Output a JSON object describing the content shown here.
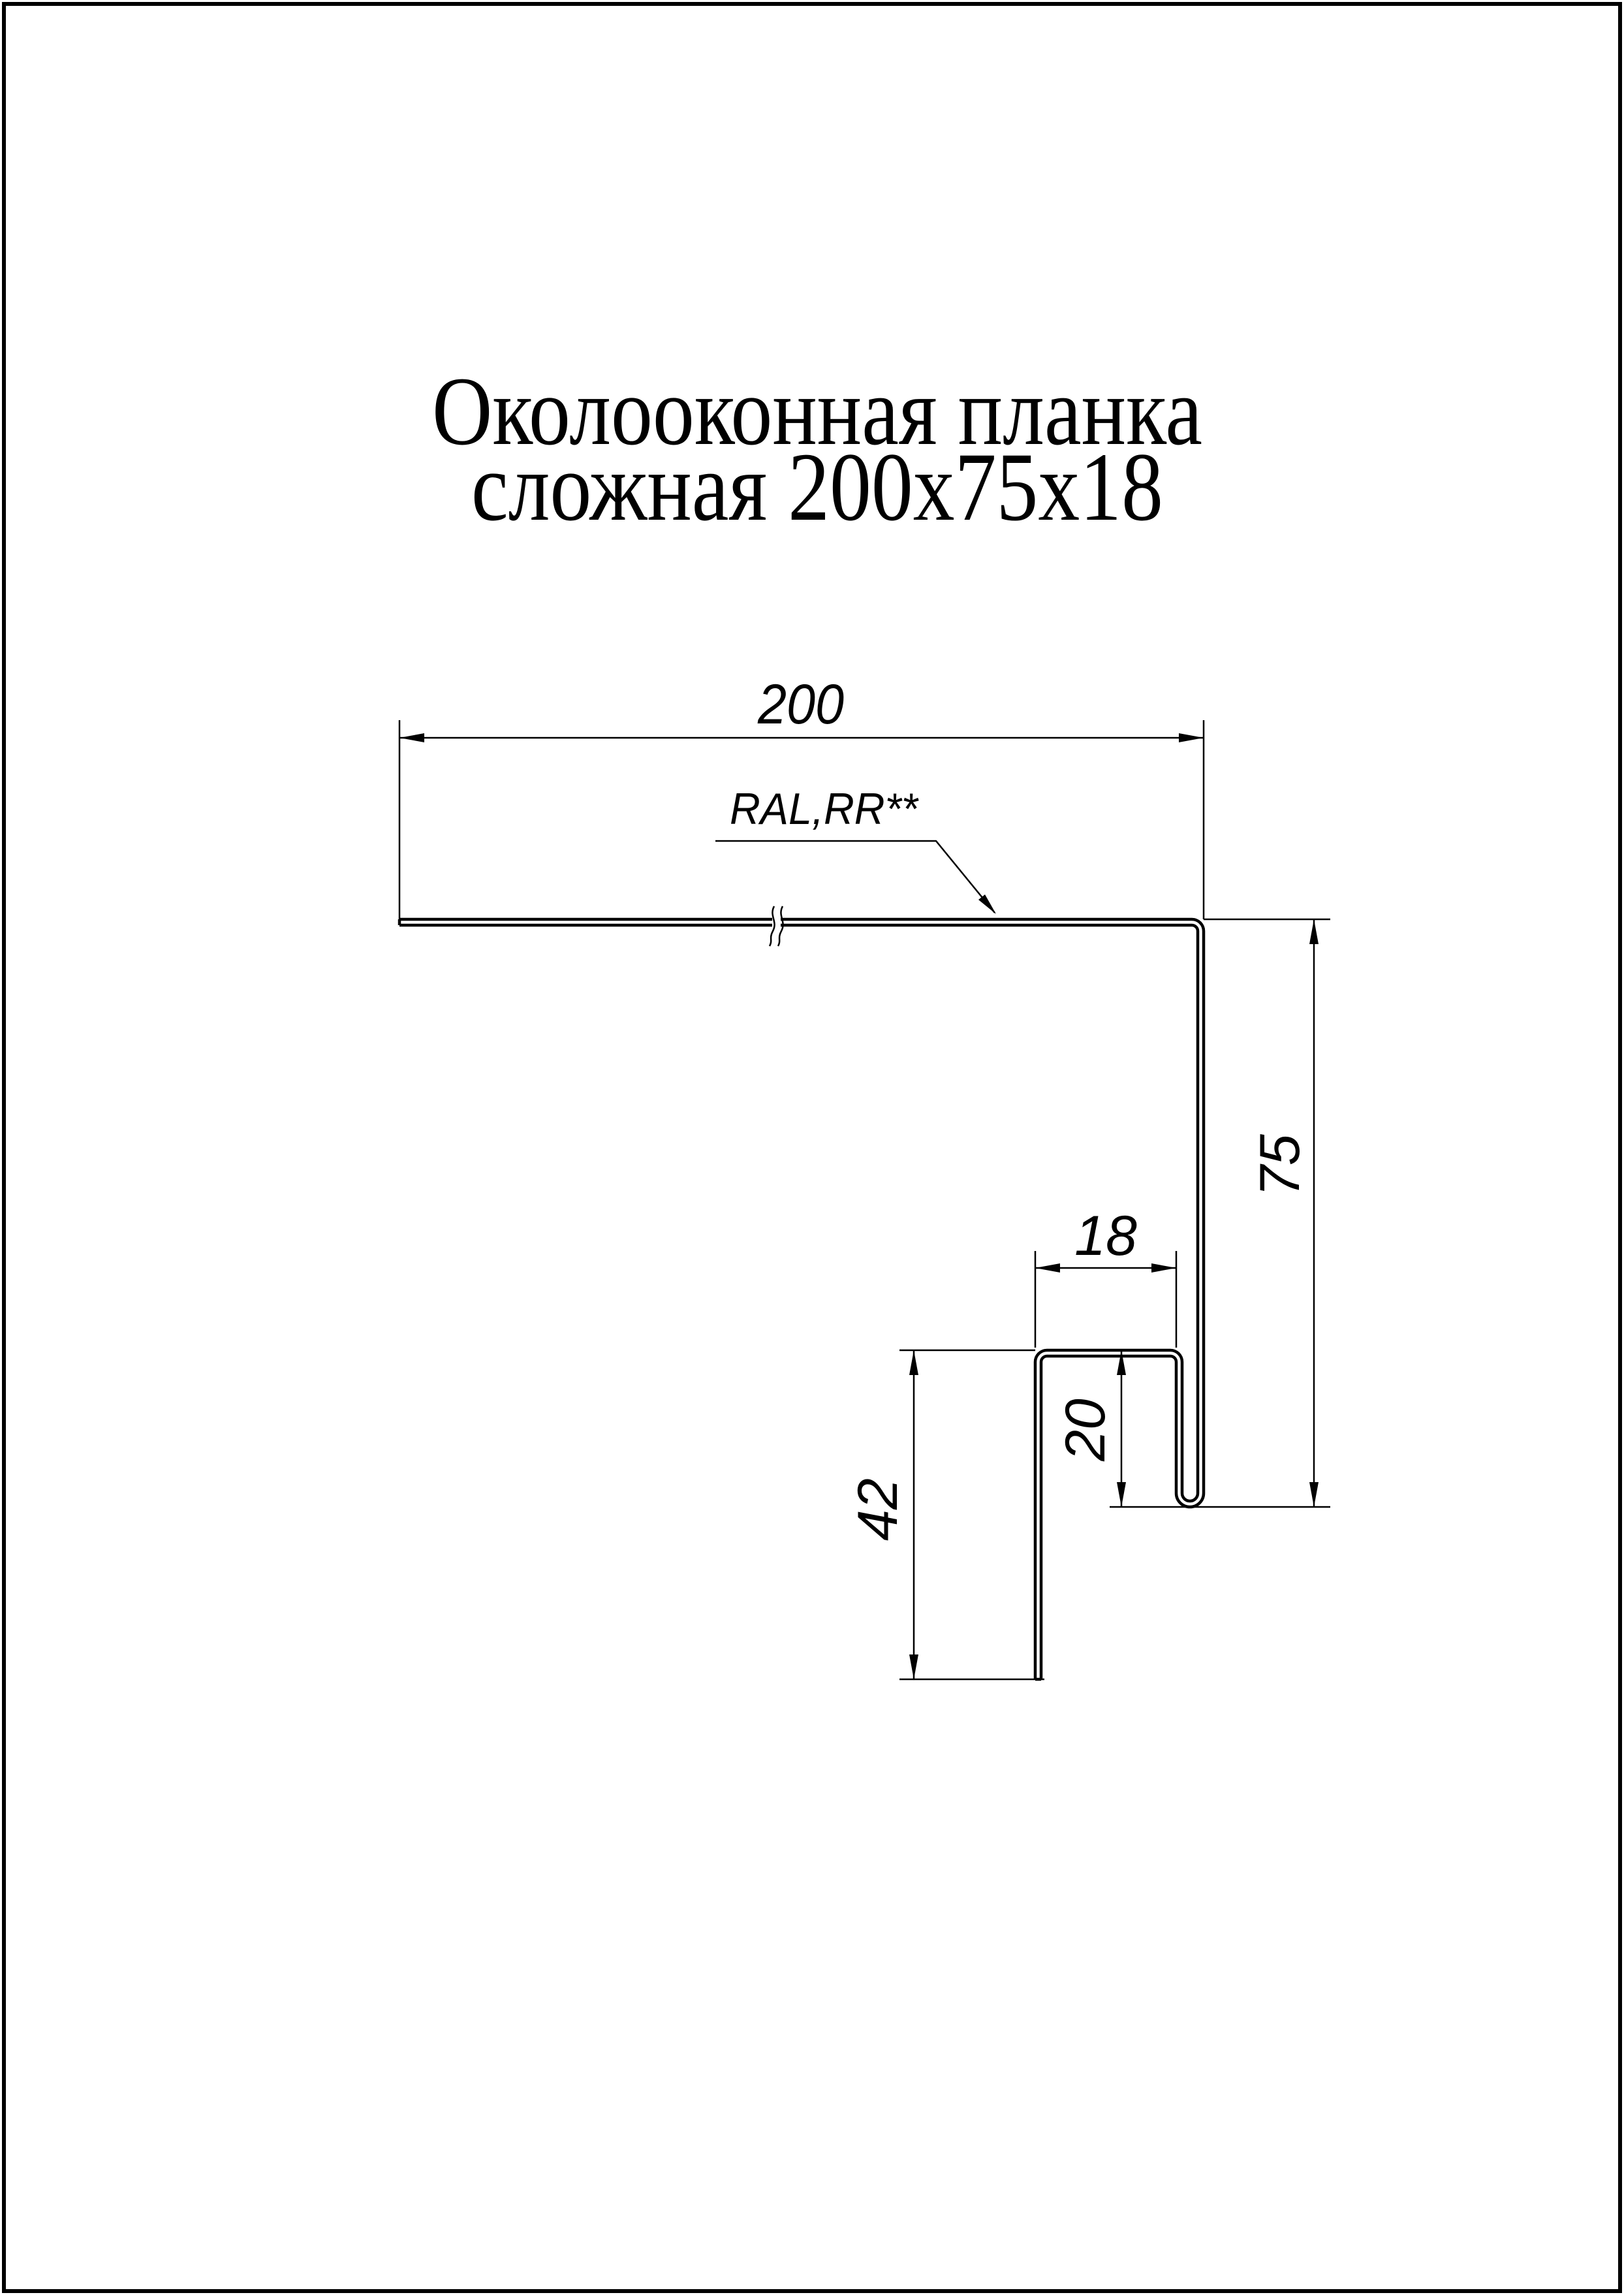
{
  "page": {
    "background": "#ffffff",
    "ink": "#000000"
  },
  "title": {
    "line1": "Околооконная планка",
    "line2": "сложная 200х75х18"
  },
  "labels": {
    "material": "RAL,RR**"
  },
  "dimensions": {
    "flange_width": "200",
    "right_height": "75",
    "shelf_width": "18",
    "hook_height": "20",
    "leg_height": "42"
  }
}
